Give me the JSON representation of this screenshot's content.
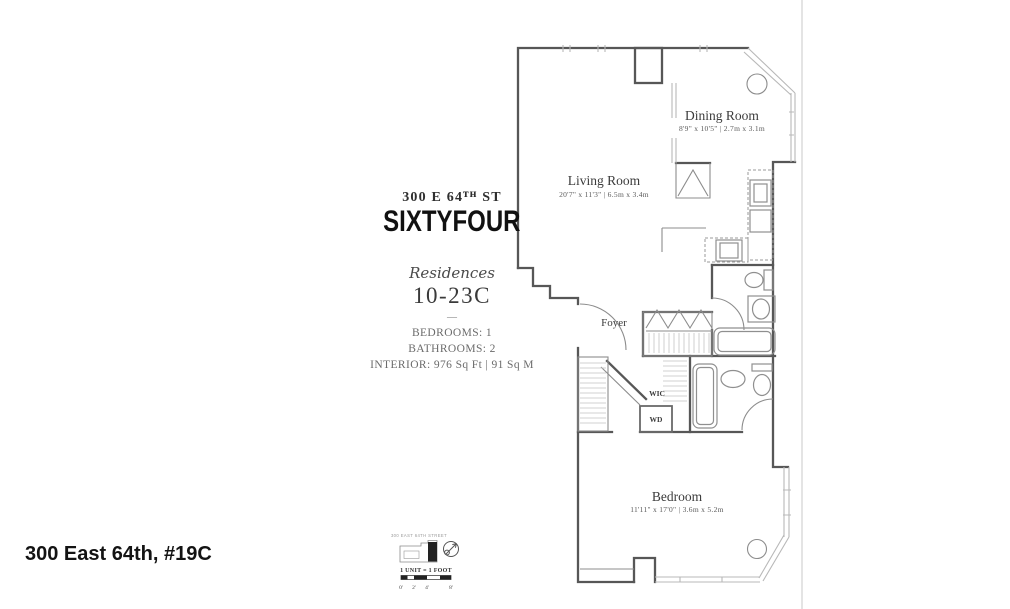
{
  "page": {
    "footer_label": "300 East 64th, #19C",
    "background": "#ffffff",
    "border_color": "#c9c9c9"
  },
  "info_panel": {
    "address": "300 E 64ᵀᴴ ST",
    "building_name": "SIXTYFOUR",
    "residences_label": "Residences",
    "unit_range": "10-23C",
    "divider": "—",
    "bedrooms": "BEDROOMS: 1",
    "bathrooms": "BATHROOMS: 2",
    "interior": "INTERIOR: 976 Sq Ft | 91 Sq M"
  },
  "floor_plan": {
    "line_color": "#575757",
    "rooms": {
      "living": {
        "name": "Living Room",
        "dims": "20'7\" x 11'3\" | 6.5m x 3.4m"
      },
      "dining": {
        "name": "Dining Room",
        "dims": "8'9\" x 10'5\" | 2.7m x 3.1m"
      },
      "foyer": {
        "name": "Foyer"
      },
      "wic": {
        "name": "WIC"
      },
      "wd": {
        "name": "WD"
      },
      "bedroom": {
        "name": "Bedroom",
        "dims": "11'11\" x 17'0\" | 3.6m x 5.2m"
      }
    }
  },
  "key_plan": {
    "street_label": "300 EAST 64TH STREET",
    "scale_label": "1 UNIT = 1 FOOT",
    "scale_ticks": [
      "0'",
      "2'",
      "4'",
      "8'"
    ]
  }
}
